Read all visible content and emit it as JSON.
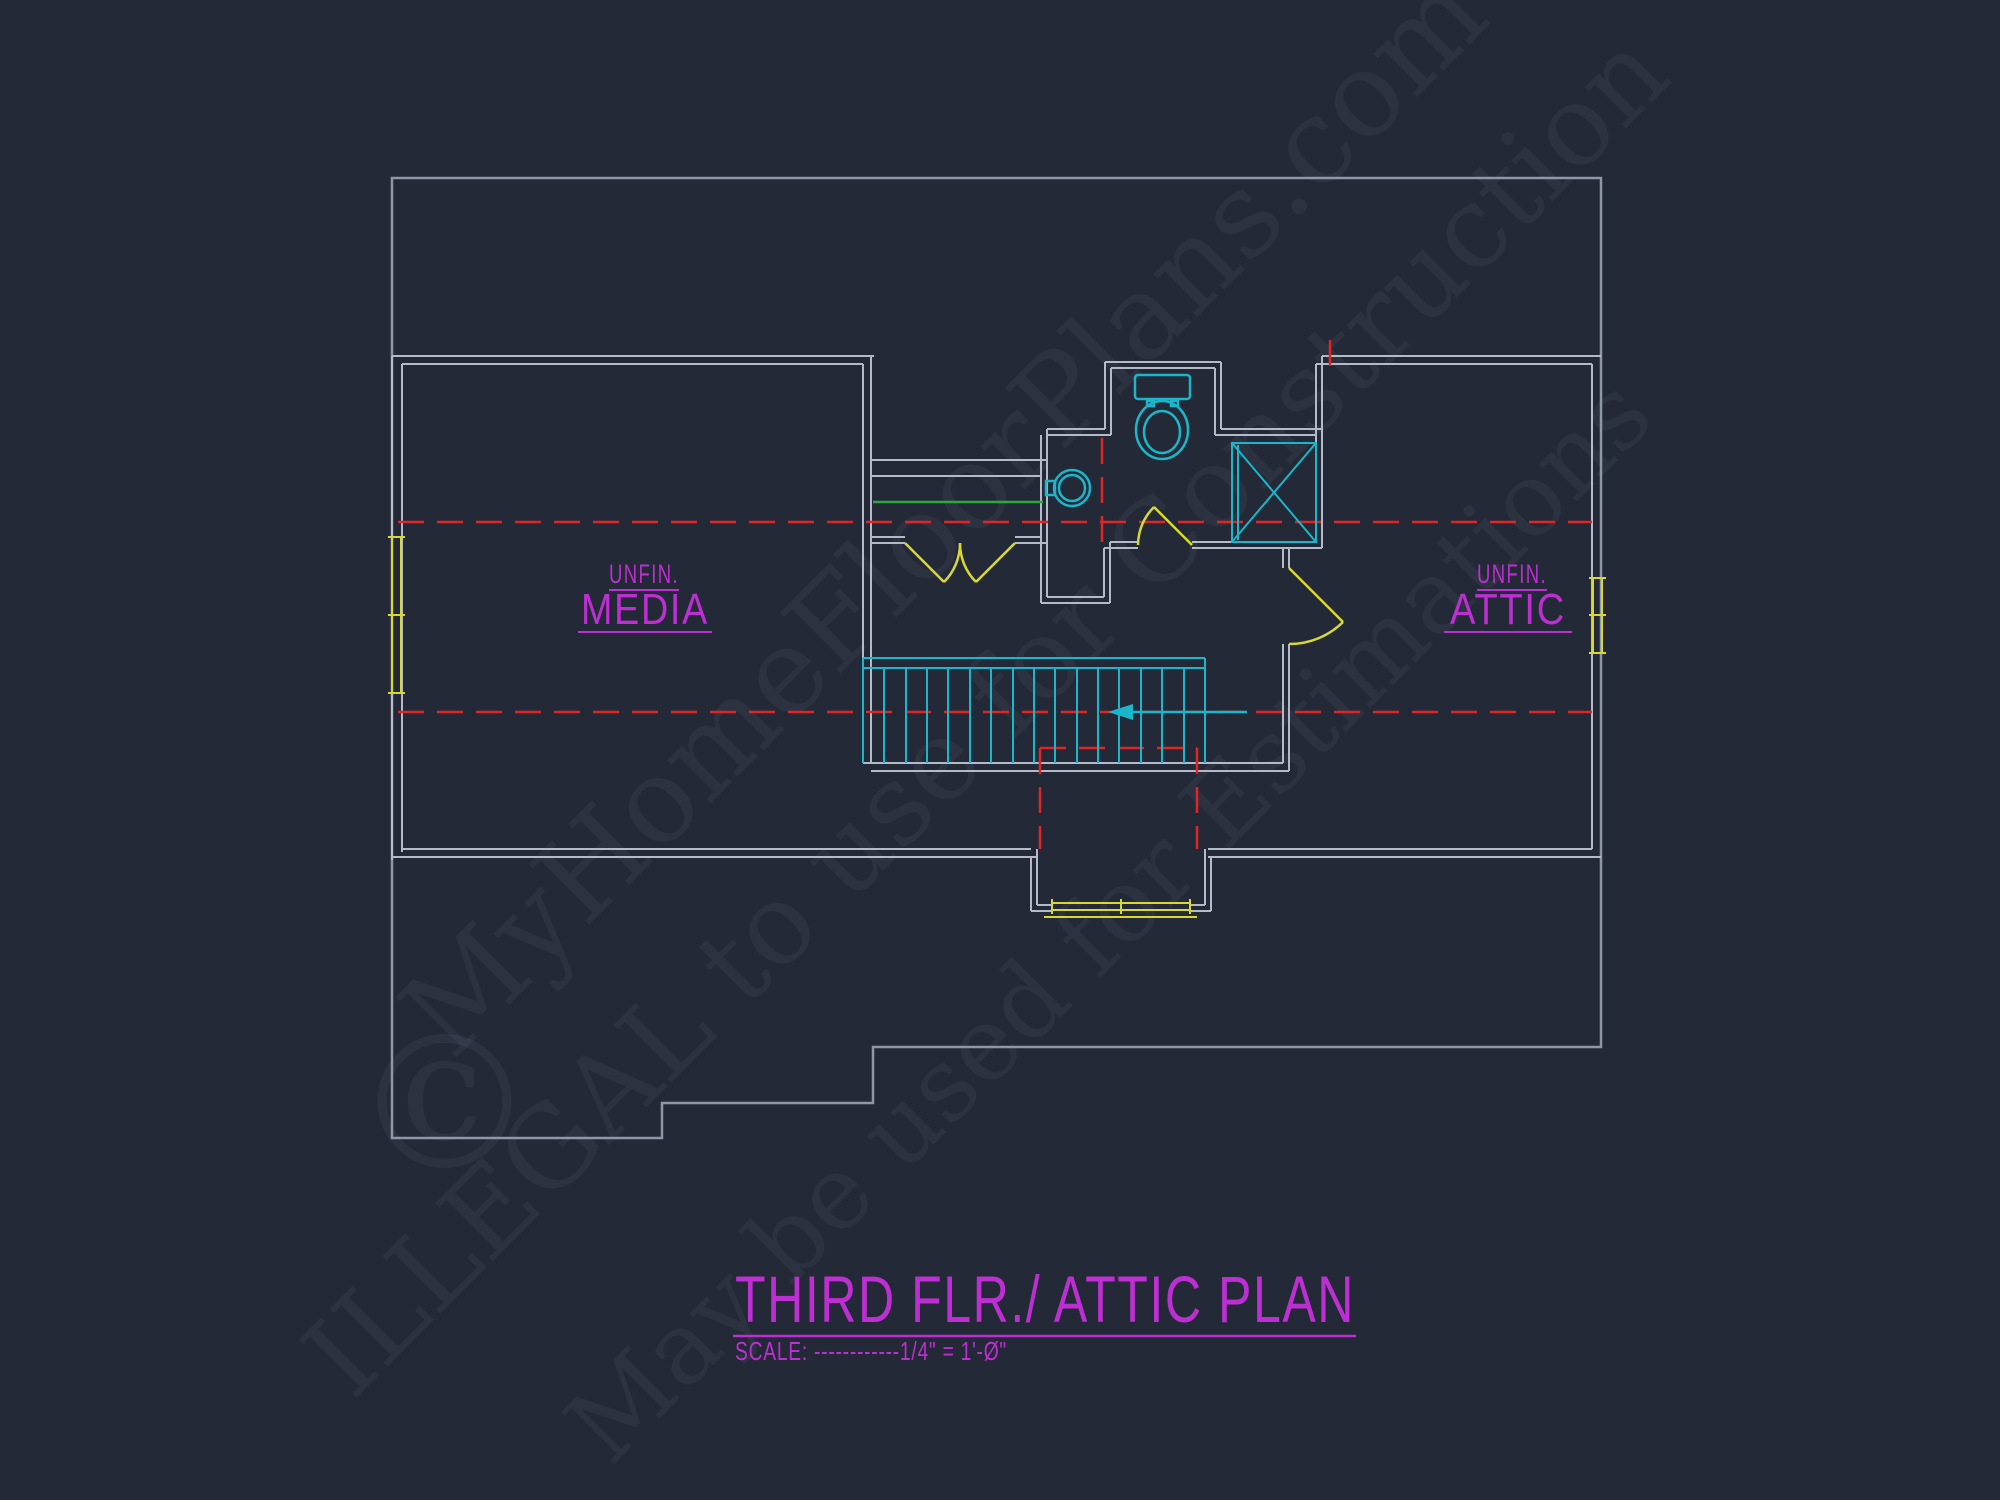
{
  "colors": {
    "background": "#242937",
    "roof_outline": "#8f96a8",
    "walls": "#b5bac8",
    "centerline_red": "#e02525",
    "fixture_cyan": "#19b7c9",
    "door_window_yellow": "#d8d832",
    "shelf_green": "#2ea83c",
    "label_magenta": "#bd2fd2"
  },
  "watermark": {
    "line1": "MyHomeFloorPlans.com",
    "line2": "ILLEGAL to use for Construction",
    "line3": "May be used for Estimations",
    "copyright_symbol": "©"
  },
  "rooms": {
    "media": {
      "label_top": "UNFIN.",
      "label_main": "MEDIA"
    },
    "attic": {
      "label_top": "UNFIN.",
      "label_main": "ATTIC"
    }
  },
  "fixtures": {
    "toilet": "toilet",
    "sink": "round-sink",
    "shower": "shower-with-x",
    "stairs": "staircase-with-direction-arrow"
  },
  "title_block": {
    "title": "THIRD FLR./ ATTIC PLAN",
    "scale_note": "SCALE: ------------1/4\" = 1'-Ø\""
  }
}
